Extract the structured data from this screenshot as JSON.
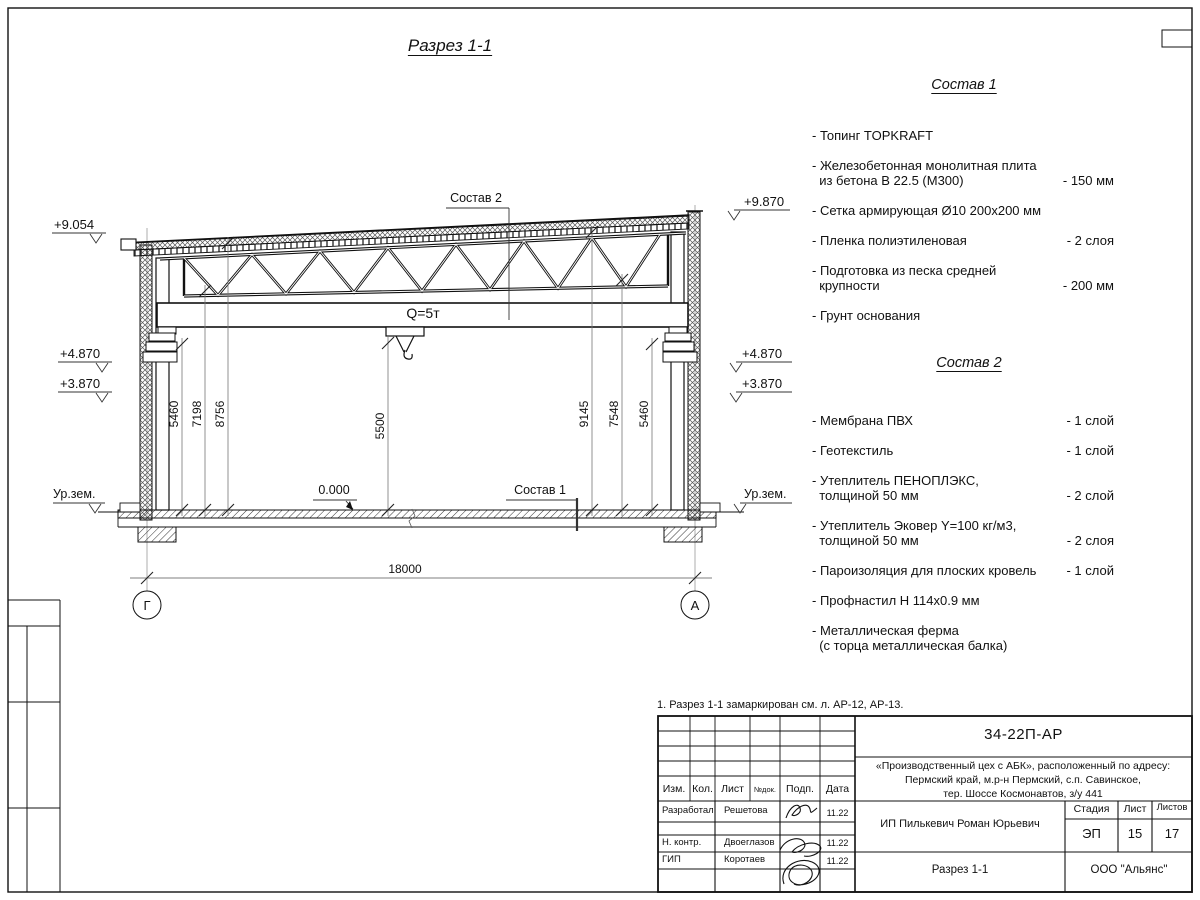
{
  "drawing": {
    "title": "Разрез 1-1",
    "crane_capacity": "Q=5т",
    "span_dim": "18000",
    "axis_left": "Г",
    "axis_right": "А",
    "zero_level": "0.000",
    "ref_sostav1": "Состав 1",
    "ref_sostav2": "Состав 2",
    "ground_level_left": "Ур.зем.",
    "ground_level_right": "Ур.зем.",
    "elevations_left": [
      "+9.054",
      "+4.870",
      "+3.870"
    ],
    "elevations_right": [
      "+9.870",
      "+4.870",
      "+3.870"
    ],
    "dims_left": [
      "5460",
      "7198",
      "8756"
    ],
    "dim_center": "5500",
    "dims_right": [
      "9145",
      "7548",
      "5460"
    ]
  },
  "sostav1": {
    "heading": "Состав 1",
    "items": [
      {
        "name": "- Топинг TOPKRAFT",
        "value": ""
      },
      {
        "name": "- Железобетонная  монолитная плита\n  из бетона В 22.5 (М300)",
        "value": "- 150 мм"
      },
      {
        "name": "- Сетка армирующая Ø10 200х200 мм",
        "value": ""
      },
      {
        "name": "- Пленка полиэтиленовая",
        "value": "-  2 слоя"
      },
      {
        "name": "- Подготовка из песка средней\n  крупности",
        "value": "- 200 мм"
      },
      {
        "name": "- Грунт основания",
        "value": ""
      }
    ]
  },
  "sostav2": {
    "heading": "Состав 2",
    "items": [
      {
        "name": "- Мембрана ПВХ",
        "value": "- 1 слой"
      },
      {
        "name": "- Геотекстиль",
        "value": "- 1 слой"
      },
      {
        "name": "- Утеплитель ПЕНОПЛЭКС,\n  толщиной 50 мм",
        "value": "- 2 слой"
      },
      {
        "name": "- Утеплитель Эковер Y=100 кг/м3,\n  толщиной 50 мм",
        "value": "- 2 слоя"
      },
      {
        "name": "- Пароизоляция для плоских кровель",
        "value": "- 1 слой"
      },
      {
        "name": "- Профнастил Н 114х0.9 мм",
        "value": ""
      },
      {
        "name": "- Металлическая ферма\n  (с торца металлическая балка)",
        "value": ""
      }
    ]
  },
  "note": "1. Разрез 1-1 замаркирован см. л. АР-12, АР-13.",
  "titleblock": {
    "doc_code": "34-22П-АР",
    "project": "«Производственный цех с АБК», расположенный по адресу:\nПермский край, м.р-н Пермский, с.п. Савинское,\nтер. Шоссе Космонавтов, з/у 441",
    "client": "ИП Пилькевич Роман Юрьевич",
    "sheet_title": "Разрез 1-1",
    "company": "ООО \"Альянс\"",
    "cols": {
      "izm": "Изм.",
      "kol": "Кол.",
      "list": "Лист",
      "ndok": "№док.",
      "podp": "Подп.",
      "data": "Дата"
    },
    "stage_label": "Стадия",
    "sheet_label": "Лист",
    "sheets_label": "Листов",
    "stage": "ЭП",
    "sheet_no": "15",
    "sheets_total": "17",
    "rows": [
      {
        "role": "Разработал",
        "name": "Решетова",
        "date": "11.22"
      },
      {
        "role": "Н. контр.",
        "name": "Двоеглазов",
        "date": "11.22"
      },
      {
        "role": "ГИП",
        "name": "Коротаев",
        "date": "11.22"
      }
    ]
  }
}
